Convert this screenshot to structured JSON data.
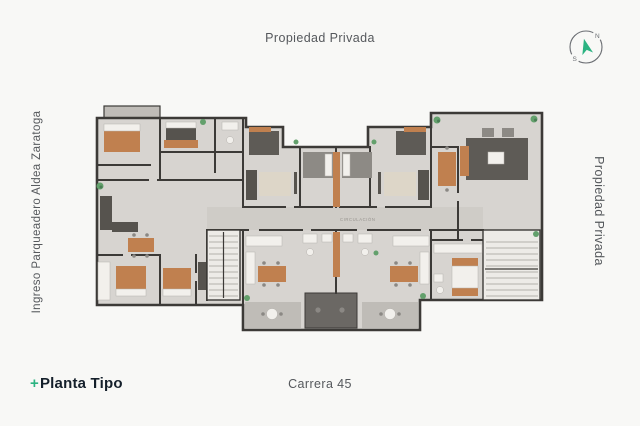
{
  "labels": {
    "top": "Propiedad Privada",
    "right": "Propiedad Privada",
    "left": "Ingreso Parqueadero Aldea Zaratoga",
    "bottom_center": "Carrera 45",
    "plan_title_prefix": "+",
    "plan_title": "Planta Tipo",
    "corridor": "CIRCULACIÓN"
  },
  "compass": {
    "north": "N",
    "south": "S"
  },
  "colors": {
    "page_bg": "#f8f8f6",
    "accent_green": "#2bb381",
    "title_dark": "#15202b",
    "label_gray": "#55585c",
    "wall": "#3c3a37",
    "floor": "#d7d4d0",
    "floor_dark": "#bfbcb7",
    "corridor": "#cfccc7",
    "wood": "#c0804f",
    "furniture_dark": "#56534e",
    "furniture_gray": "#8d8a85",
    "fixture_white": "#f2f0ec",
    "rug_beige": "#ddd6c8",
    "rug_dark": "#5e5b56",
    "stair_bg": "#edebe7",
    "tread": "#a09d98",
    "terrace_dark": "#6b6864",
    "plant_green": "#63a06c",
    "compass_gray": "#6a6d72"
  }
}
